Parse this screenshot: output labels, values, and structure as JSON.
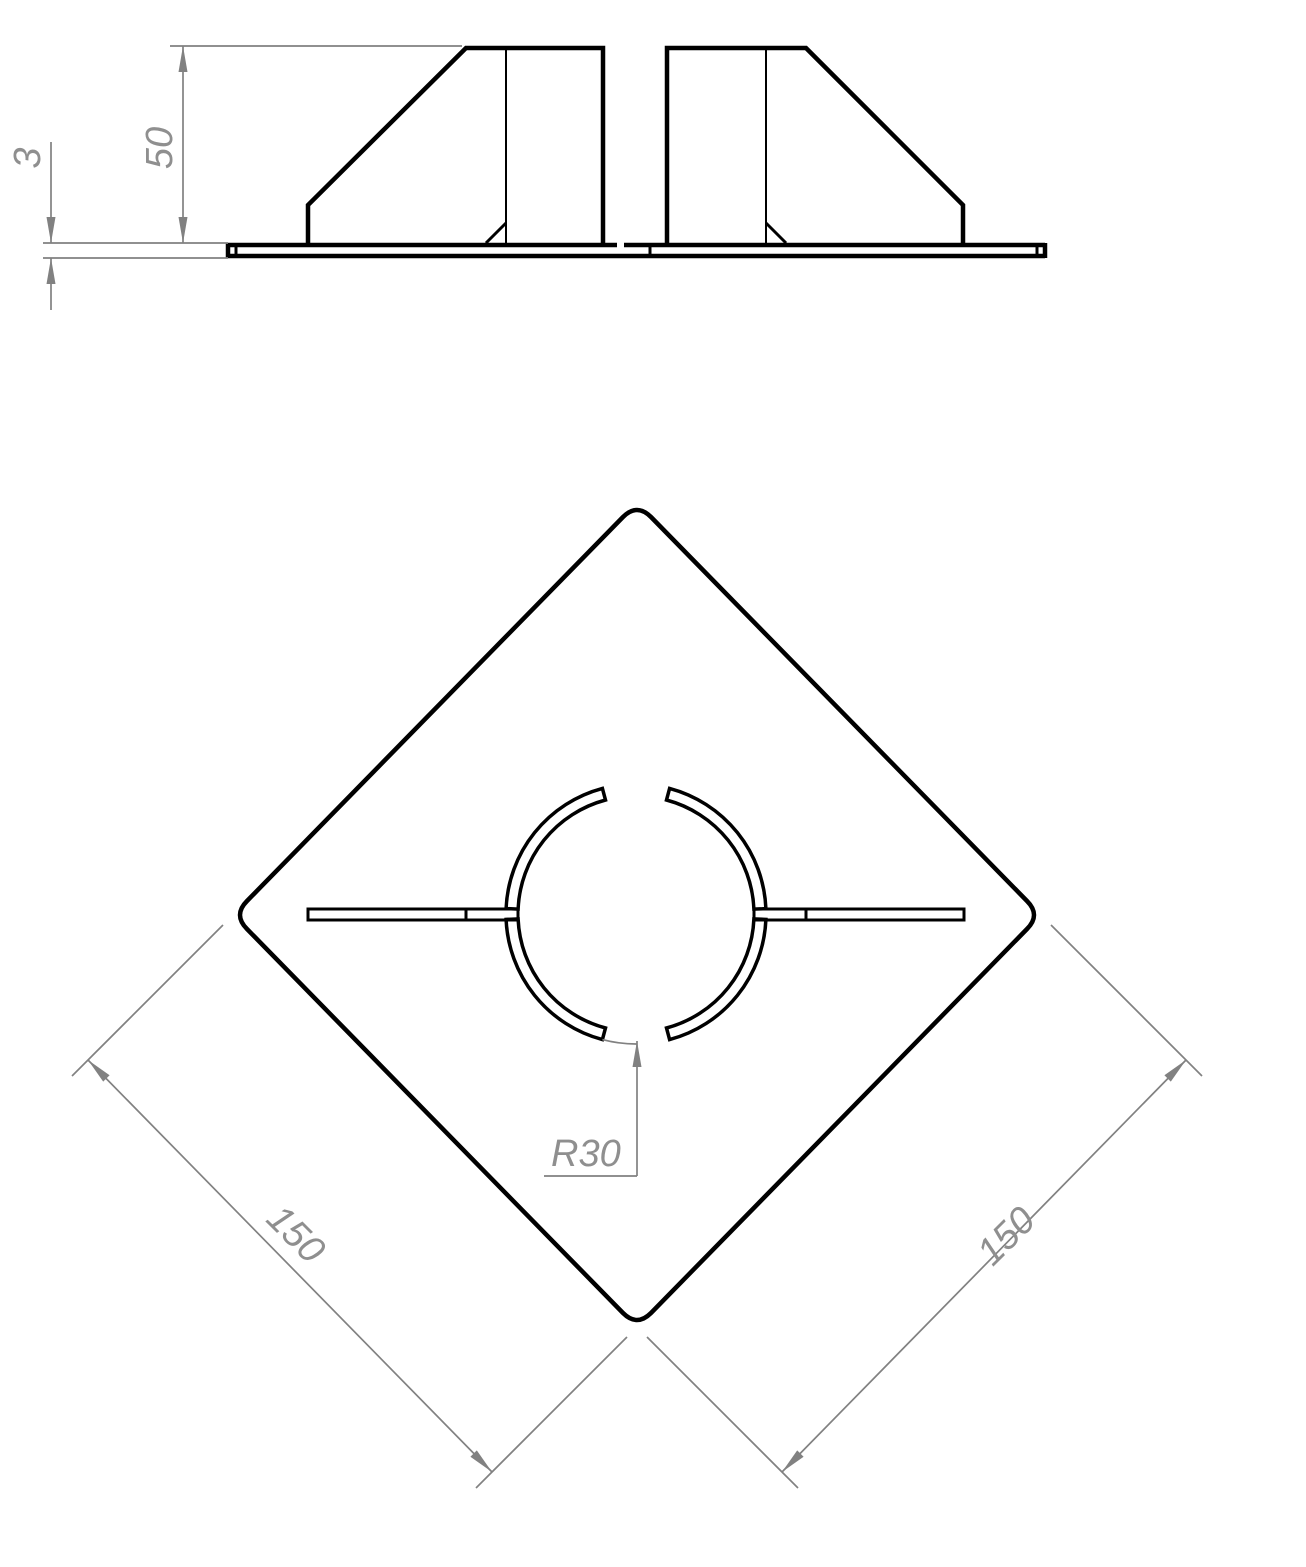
{
  "drawing": {
    "side_view": {
      "height": "50",
      "thickness": "3"
    },
    "plan_view": {
      "radius": "R30",
      "side_left": "150",
      "side_right": "150"
    }
  },
  "colors": {
    "outline": "#000000",
    "dimension_lines": "#818181",
    "dimension_text": "#8f8f8f",
    "background": "#ffffff"
  }
}
